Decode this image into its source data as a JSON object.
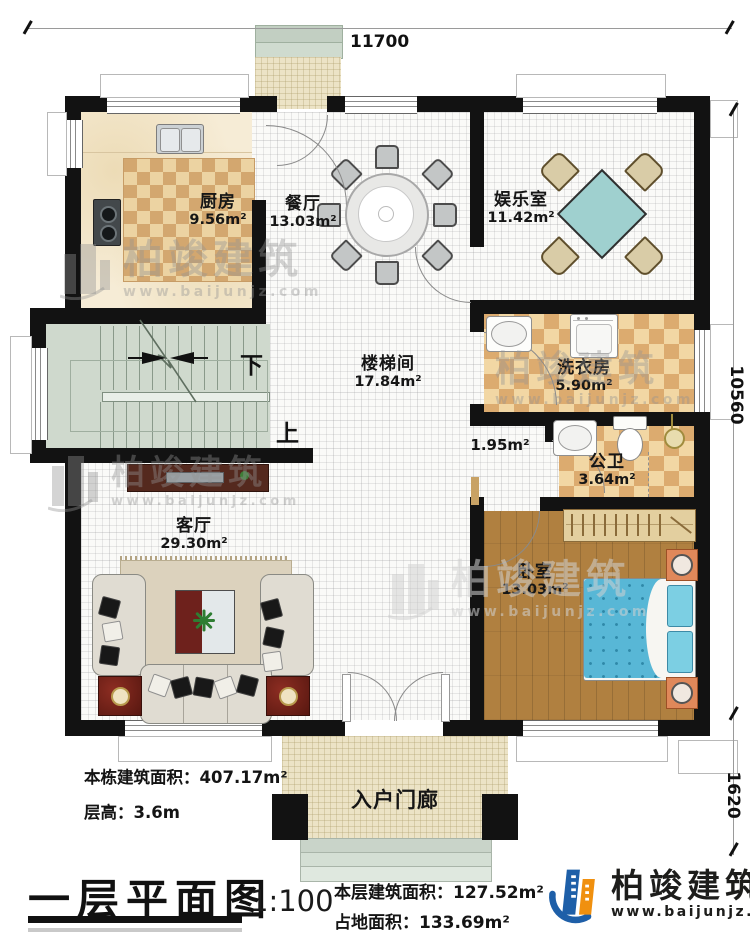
{
  "dimensions": {
    "top": "11700",
    "right_upper": "10560",
    "right_lower": "1620"
  },
  "rooms": {
    "kitchen": {
      "name": "厨房",
      "area": "9.56m²"
    },
    "dining": {
      "name": "餐厅",
      "area": "13.03m²"
    },
    "entertainment": {
      "name": "娱乐室",
      "area": "11.42m²"
    },
    "stairwell": {
      "name": "楼梯间",
      "area": "17.84m²"
    },
    "laundry": {
      "name": "洗衣房",
      "area": "5.90m²"
    },
    "corridor": {
      "area": "1.95m²"
    },
    "bathroom": {
      "name": "公卫",
      "area": "3.64m²"
    },
    "living": {
      "name": "客厅",
      "area": "29.30m²"
    },
    "bedroom": {
      "name": "卧室",
      "area": "13.03m²"
    },
    "porch": {
      "name": "入户门廊"
    }
  },
  "stairs": {
    "down": "下",
    "up": "上"
  },
  "info": {
    "building_total_area": "本栋建筑面积：407.17m²",
    "floor_height": "层高：3.6m",
    "floor_area": "本层建筑面积：127.52m²",
    "land_area": "占地面积：133.69m²"
  },
  "title_block": {
    "title": "一层平面图",
    "scale": "1:100"
  },
  "watermark": {
    "brand": "柏竣建筑",
    "url": "www.baijunjz.com"
  },
  "logo": {
    "brand": "柏竣建筑",
    "url": "www.baijunjz.com"
  },
  "colors": {
    "wall": "#121212",
    "logo_blue": "#1e5fa8",
    "logo_orange": "#f0900f",
    "table_teal": "#9fd0cf",
    "bed_blue": "#58b7d6"
  }
}
